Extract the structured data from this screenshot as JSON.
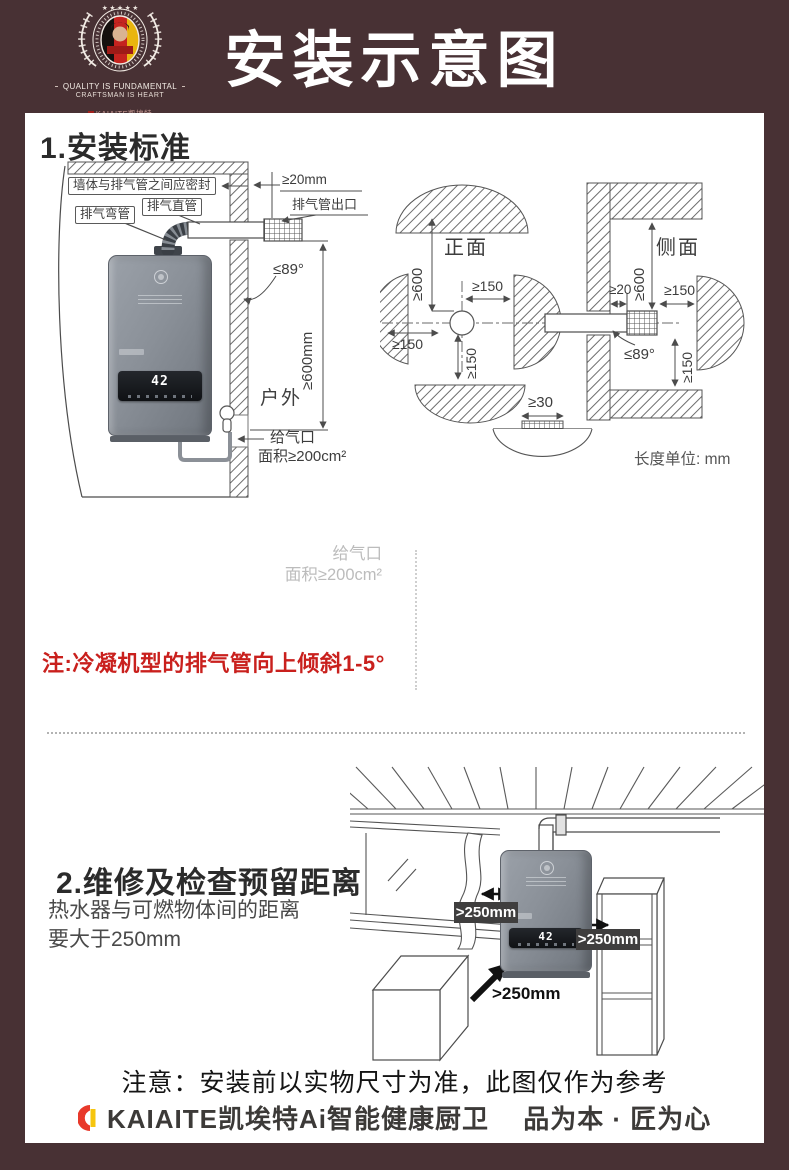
{
  "colors": {
    "header_bg": "#483134",
    "card_bg": "#ffffff",
    "note_red": "#c9201d",
    "badge_bg": "#3f3e3e",
    "accent_red": "#e8392b",
    "accent_yellow": "#f6c50e"
  },
  "header": {
    "title": "安装示意图",
    "logo_line1": "QUALITY IS FUNDAMENTAL",
    "logo_line2": "CRAFTSMAN IS HEART",
    "logo_badge": "KAIAITE凯埃特"
  },
  "s1": {
    "heading": "1.安装标准",
    "display": "42",
    "wall": {
      "seal": "墙体与排气管之间应密封",
      "straight": "排气直管",
      "elbow": "排气弯管",
      "gap": "≥20mm",
      "outlet": "排气管出口",
      "angle": "≤89°",
      "height": "≥600mm",
      "outdoor": "户外",
      "air_label": "给气口",
      "air_area": "面积≥200cm²"
    },
    "front": {
      "title": "正面",
      "top": "≥600",
      "right": "≥150",
      "left": "≥150",
      "bottom": "≥150"
    },
    "side": {
      "title": "侧面",
      "top": "≥600",
      "gap": "≥20",
      "right": "≥150",
      "angle": "≤89°",
      "bottom": "≥150"
    },
    "floor": {
      "clearance": "≥30"
    },
    "unit": "长度单位: mm",
    "faded_line1": "给气口",
    "faded_line2": "面积≥200cm²",
    "note": "注:冷凝机型的排气管向上倾斜1-5°"
  },
  "s2": {
    "heading": "2.维修及检查预留距离",
    "body1": "热水器与可燃物体间的距离",
    "body2": "要大于250mm",
    "clearance_left": ">250mm",
    "clearance_right": ">250mm",
    "clearance_bottom": ">250mm"
  },
  "footer": {
    "notice": "注意：安装前以实物尺寸为准，此图仅作为参考",
    "brand": "KAIAITE凯埃特Ai智能健康厨卫",
    "slogan": "品为本 · 匠为心"
  }
}
